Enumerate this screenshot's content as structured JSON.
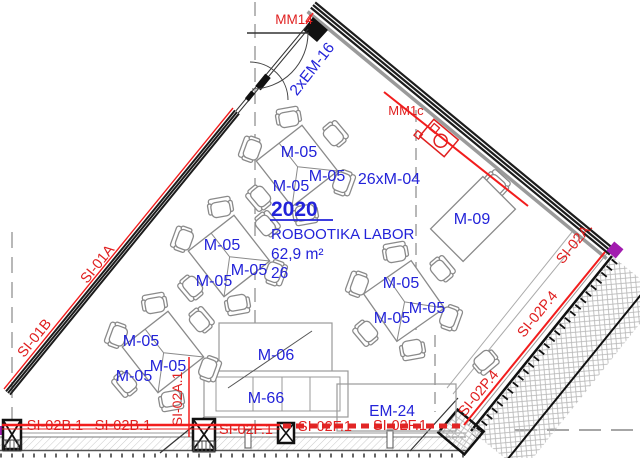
{
  "room": {
    "number": "2020",
    "name": "ROBOOTIKA LABOR",
    "area": "62,9 m²",
    "capacity": "26"
  },
  "furniture": {
    "table": "M-05",
    "chairs": "26xM-04",
    "desk": "M-09",
    "cabinet": "M-06",
    "bench": "M-66",
    "equipment": "EM-24",
    "door_top": "2xEM-16"
  },
  "markers": {
    "mm14": "MM14",
    "mm1c": "MM1c"
  },
  "fire_labels": {
    "si01a": "SI-01A",
    "si01b": "SI-01B",
    "si02b1": "SI-02B.1",
    "si02a1": "SI-02A.1",
    "si02f1": "SI-02F.1",
    "si02a_right": "SI-02A.",
    "si02p4": "SI-02P.4"
  },
  "colors": {
    "label_blue": "#2323d9",
    "marker_red": "#e01f1f",
    "line_red": "#f21d1d",
    "wall_black": "#1c1c1c",
    "furniture_gray": "#8a8a8a",
    "accent_purple": "#a21caf"
  }
}
